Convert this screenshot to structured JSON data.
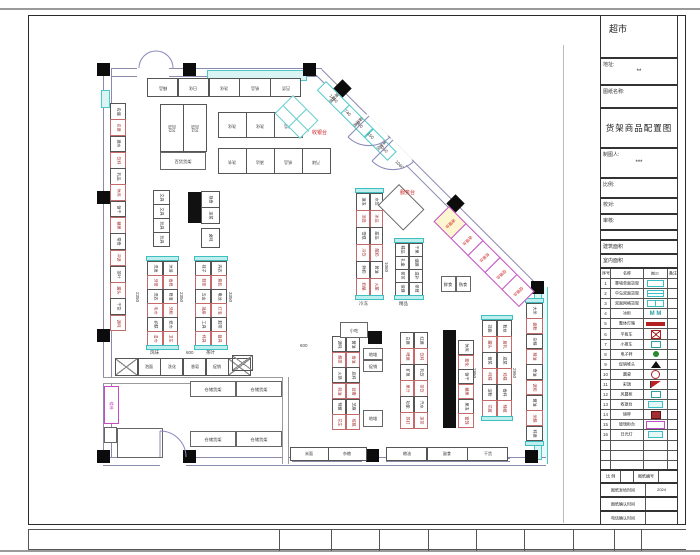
{
  "title_block": {
    "store_name": "超市",
    "address_label": "地址:",
    "address_value": "**",
    "drawing_name_label": "图纸名称:",
    "drawing_title": "货架商品配置图",
    "drafter_label": "制图人:",
    "drafter_value": "***",
    "scale_label": "比例:",
    "check_label": "校对:",
    "audit_label": "审核:",
    "building_area_label": "建筑面积",
    "indoor_area_label": "室内面积",
    "legend_header": [
      "序号",
      "名称",
      "图示",
      "备注"
    ],
    "legend_rows": [
      {
        "no": "1",
        "name": "靠墙单面货架",
        "sym": "cyanopen"
      },
      {
        "no": "2",
        "name": "中岛双面货架",
        "sym": "cyanrect"
      },
      {
        "no": "3",
        "name": "双面网格货架",
        "sym": "cyangrid"
      },
      {
        "no": "4",
        "name": "冰柜",
        "sym": "m",
        "symtext": "M M"
      },
      {
        "no": "5",
        "name": "整体灯箱",
        "sym": "redbar"
      },
      {
        "no": "6",
        "name": "平板车",
        "sym": "redx"
      },
      {
        "no": "7",
        "name": "小推车",
        "sym": "tealsm"
      },
      {
        "no": "8",
        "name": "电子秤",
        "sym": "green"
      },
      {
        "no": "9",
        "name": "促销堆头",
        "sym": "tri"
      },
      {
        "no": "10",
        "name": "圆桌",
        "sym": "circ"
      },
      {
        "no": "11",
        "name": "彩旗",
        "sym": "flag"
      },
      {
        "no": "12",
        "name": "风幕柜",
        "sym": "tealsm"
      },
      {
        "no": "13",
        "name": "收银台",
        "sym": "cyanbox"
      },
      {
        "no": "14",
        "name": "磅秤",
        "sym": "brown"
      },
      {
        "no": "15",
        "name": "玻璃柜台",
        "sym": "mag"
      },
      {
        "no": "16",
        "name": "日光灯",
        "sym": "cyanbox"
      },
      {
        "no": "",
        "name": "",
        "sym": "none"
      },
      {
        "no": "",
        "name": "",
        "sym": "none"
      },
      {
        "no": "",
        "name": "",
        "sym": "none"
      }
    ],
    "bottom_scale_label": "比 例",
    "bottom_no_label": "图纸编号",
    "issue_label": "图纸发给时间",
    "issue_value": "2024",
    "confirm_label": "图纸确认时间",
    "confirm_value": "",
    "phone_label": "电话确认时间",
    "phone_value": ""
  },
  "plan": {
    "walls": [
      {
        "x": 103,
        "y": 68,
        "w": 219,
        "h": 7,
        "t": "h"
      },
      {
        "x": 103,
        "y": 68,
        "w": 7,
        "h": 396,
        "t": "v"
      },
      {
        "x": 539,
        "y": 287,
        "w": 7,
        "h": 177,
        "t": "v",
        "cyan": true
      },
      {
        "x": 285,
        "y": 457,
        "w": 261,
        "h": 7,
        "t": "h"
      },
      {
        "x": 103,
        "y": 457,
        "w": 57,
        "h": 7,
        "t": "h"
      },
      {
        "x": 186,
        "y": 457,
        "w": 99,
        "h": 7,
        "t": "h"
      },
      {
        "x": 103,
        "y": 377,
        "w": 182,
        "h": 5,
        "t": "h",
        "thin": true
      },
      {
        "x": 282,
        "y": 377,
        "w": 5,
        "h": 87,
        "t": "v",
        "thin": true
      },
      {
        "x": 322,
        "y": 69,
        "w": 310,
        "h": 7,
        "t": "h",
        "rot": 45
      }
    ],
    "wall_gaps": [
      {
        "x": 137,
        "y": 66,
        "w": 32,
        "h": 11
      },
      {
        "x": 367,
        "y": 114,
        "w": 30,
        "h": 10,
        "rot": 45
      },
      {
        "x": 391,
        "y": 138,
        "w": 30,
        "h": 10,
        "rot": 45
      }
    ],
    "cyan_bands": [
      {
        "x": 207,
        "y": 70,
        "w": 98,
        "h": 9
      },
      {
        "x": 101,
        "y": 90,
        "w": 7,
        "h": 16
      },
      {
        "x": 534,
        "y": 292,
        "w": 6,
        "h": 166
      }
    ],
    "hatches": [
      {
        "x": 292,
        "y": 458,
        "w": 70,
        "h": 6
      },
      {
        "x": 386,
        "y": 458,
        "w": 124,
        "h": 6
      }
    ],
    "columns": [
      [
        97,
        63
      ],
      [
        183,
        63
      ],
      [
        303,
        63
      ],
      [
        97,
        191
      ],
      [
        97,
        329
      ],
      [
        97,
        450
      ],
      [
        183,
        450
      ],
      [
        366,
        449
      ],
      [
        525,
        450
      ],
      [
        531,
        281
      ],
      [
        336,
        82,
        45
      ],
      [
        449,
        197,
        45
      ]
    ],
    "black_bars": [
      [
        188,
        192,
        13,
        31
      ],
      [
        356,
        191,
        13,
        30
      ],
      [
        443,
        330,
        13,
        98
      ],
      [
        368,
        331,
        14,
        13
      ],
      [
        196,
        331,
        13,
        13
      ]
    ],
    "runs": [
      {
        "name": "left-wall-run",
        "x": 110,
        "y": 103,
        "w": 16,
        "h": 228,
        "dir": "v",
        "alt": true,
        "cells": [
          "名烟",
          "名酒",
          "酒水",
          "饮料",
          "乳品",
          "休闲",
          "饼干",
          "糖果",
          "零食",
          "冲调",
          "茶叶",
          "罐头",
          "干货",
          "调味"
        ]
      },
      {
        "name": "top-wall-run",
        "x": 147,
        "y": 78,
        "w": 154,
        "h": 19,
        "dir": "h",
        "rot180": true,
        "cells": [
          "精品",
          "日化",
          "洗化",
          "纸品",
          "百货"
        ]
      },
      {
        "name": "dept-block",
        "x": 160,
        "y": 104,
        "w": 46,
        "h": 48,
        "dir": "h",
        "rot180": true,
        "cells": [
          "915\n百货",
          "913\n百货"
        ]
      },
      {
        "name": "chem-run",
        "x": 218,
        "y": 112,
        "w": 84,
        "h": 26,
        "dir": "h",
        "rot180": true,
        "cells": [
          "洗化",
          "洗化",
          "纸品"
        ]
      },
      {
        "name": "clean-run",
        "x": 218,
        "y": 148,
        "w": 112,
        "h": 26,
        "dir": "h",
        "rot180": true,
        "cells": [
          "洗衣",
          "清洁",
          "纸品",
          "汽球"
        ]
      },
      {
        "name": "stationery-run",
        "x": 153,
        "y": 190,
        "w": 17,
        "h": 56,
        "dir": "v",
        "cells": [
          "文具",
          "文具",
          "玩具",
          "玩具"
        ]
      },
      {
        "name": "deli-run",
        "x": 201,
        "y": 191,
        "w": 19,
        "h": 32,
        "dir": "v",
        "cells": [
          "熟食",
          "凉菜"
        ]
      },
      {
        "name": "deli-run2",
        "x": 201,
        "y": 228,
        "w": 19,
        "h": 19,
        "dir": "v",
        "cells": [
          "卤味"
        ]
      },
      {
        "name": "gondola-1",
        "x": 147,
        "y": 256,
        "w": 31,
        "h": 94,
        "dir": "v",
        "cols": 2,
        "cap": true,
        "alt": true,
        "cells": [
          "洗发",
          "沐浴",
          "牙膏",
          "香皂",
          "洗衣",
          "皂液",
          "毛巾",
          "牙刷",
          "护肤",
          "纸巾",
          "湿巾",
          "卫生"
        ]
      },
      {
        "name": "gondola-2",
        "x": 195,
        "y": 256,
        "w": 32,
        "h": 94,
        "dir": "v",
        "cols": 2,
        "cap": true,
        "alt": true,
        "cells": [
          "袜子",
          "内衣",
          "鞋垫",
          "箱包",
          "五金",
          "电池",
          "插座",
          "灯泡",
          "工具",
          "胶带",
          "杯具",
          "餐具"
        ]
      },
      {
        "name": "frozen-run",
        "x": 356,
        "y": 188,
        "w": 27,
        "h": 112,
        "dir": "v",
        "cols": 2,
        "cap": true,
        "alt": true,
        "cells": [
          "速冻",
          "水饺",
          "汤圆",
          "冰品",
          "雪糕",
          "甜品",
          "冷饮",
          "酸奶",
          "鲜奶",
          "黄油",
          "奶酪",
          "火腿"
        ]
      },
      {
        "name": "boutique-run",
        "x": 395,
        "y": 238,
        "w": 28,
        "h": 62,
        "dir": "v",
        "cols": 2,
        "cap": true,
        "cells": [
          "精品",
          "干果",
          "礼盒",
          "烟酒",
          "茗茶",
          "滋补",
          "保健",
          "参茸"
        ]
      },
      {
        "name": "grocery-gondola",
        "x": 482,
        "y": 315,
        "w": 30,
        "h": 106,
        "dir": "v",
        "cols": 2,
        "cap": true,
        "alt": true,
        "cells": [
          "挂面",
          "粉丝",
          "罐头",
          "腐乳",
          "酱菜",
          "咸菜",
          "味精",
          "鸡精",
          "淀粉",
          "香料",
          "花椒",
          "辣椒"
        ]
      },
      {
        "name": "right-wall-run",
        "x": 526,
        "y": 298,
        "w": 17,
        "h": 148,
        "dir": "v",
        "cap": true,
        "alt": true,
        "cells": [
          "大米",
          "面粉",
          "杂粮",
          "粮油",
          "食油",
          "调和",
          "酱油",
          "米醋",
          "料酒"
        ]
      },
      {
        "name": "sauce-gondola",
        "x": 332,
        "y": 336,
        "w": 28,
        "h": 94,
        "dir": "v",
        "cols": 2,
        "alt": true,
        "cells": [
          "调味",
          "酱油",
          "醋类",
          "香油",
          "火锅",
          "底料",
          "蚝油",
          "豆瓣",
          "辣酱",
          "芝麻",
          "花生",
          "核桃"
        ]
      },
      {
        "name": "drinks-gondola",
        "x": 400,
        "y": 332,
        "w": 28,
        "h": 96,
        "dir": "v",
        "cols": 2,
        "alt": true,
        "cells": [
          "白酒",
          "红酒",
          "啤酒",
          "饮料",
          "矿泉",
          "乳饮",
          "果汁",
          "茶饮",
          "功能",
          "汽水",
          "苏打",
          "凉茶"
        ]
      },
      {
        "name": "snack-run",
        "x": 458,
        "y": 340,
        "w": 16,
        "h": 88,
        "dir": "v",
        "alt": true,
        "cells": [
          "休闲",
          "膨化",
          "饼干",
          "糖果",
          "果冻",
          "蜜饯"
        ]
      },
      {
        "name": "promo-run",
        "x": 115,
        "y": 358,
        "w": 136,
        "h": 18,
        "dir": "h",
        "cells": [
          "※",
          "泡面",
          "洗化",
          "香皂",
          "促销",
          "※"
        ]
      },
      {
        "name": "promo-end",
        "x": 232,
        "y": 355,
        "w": 20,
        "h": 16,
        "dir": "h",
        "cells": [
          "※"
        ]
      },
      {
        "name": "bottom-wall-run-1",
        "x": 290,
        "y": 447,
        "w": 76,
        "h": 14,
        "dir": "h",
        "cells": [
          "米面",
          "杂粮"
        ]
      },
      {
        "name": "bottom-wall-run-2",
        "x": 386,
        "y": 447,
        "w": 122,
        "h": 14,
        "dir": "h",
        "cells": [
          "粮油",
          "副食",
          "干货"
        ]
      },
      {
        "name": "checkout-run",
        "x": 449,
        "y": 206,
        "w": 120,
        "h": 22,
        "dir": "h",
        "rot": 45,
        "mag": true,
        "labelrot": 90,
        "firstyellow": true,
        "cells": [
          "收银台",
          "收银台",
          "包装台",
          "促销台",
          "促销台"
        ]
      },
      {
        "name": "locker-run",
        "x": 326,
        "y": 81,
        "w": 100,
        "h": 13,
        "dir": "h",
        "rot": 45,
        "cy": true,
        "labelrot": 90,
        "cells": [
          "寄存柜",
          "储物柜",
          "推车区"
        ]
      }
    ],
    "tables": [
      {
        "name": "dept-counter",
        "x": 160,
        "y": 152,
        "w": 46,
        "h": 18,
        "cells": [
          "百货货架"
        ]
      },
      {
        "name": "snack-stand",
        "x": 340,
        "y": 322,
        "w": 28,
        "h": 16,
        "cells": [
          "小吃"
        ]
      },
      {
        "name": "floor-stack-1",
        "x": 363,
        "y": 348,
        "w": 20,
        "h": 24,
        "rows": 2,
        "cells": [
          "地堆",
          "促销"
        ]
      },
      {
        "name": "floor-stack-2",
        "x": 363,
        "y": 410,
        "w": 20,
        "h": 17,
        "cells": [
          "地堆"
        ]
      },
      {
        "name": "fresh-counter",
        "x": 441,
        "y": 276,
        "w": 30,
        "h": 16,
        "cells": [
          "鲜食",
          "熟食"
        ]
      },
      {
        "name": "storage-rack-1",
        "x": 190,
        "y": 381,
        "w": 92,
        "h": 16,
        "cells": [
          "仓储货架",
          "仓储货架"
        ]
      },
      {
        "name": "storage-rack-2",
        "x": 190,
        "y": 431,
        "w": 92,
        "h": 16,
        "cells": [
          "仓储货架",
          "仓储货架"
        ]
      },
      {
        "name": "back-room",
        "x": 117,
        "y": 428,
        "w": 46,
        "h": 30,
        "cells": [
          ""
        ]
      },
      {
        "name": "small-room",
        "x": 104,
        "y": 427,
        "w": 13,
        "h": 16,
        "cells": [
          ""
        ]
      }
    ],
    "stair": {
      "x": 104,
      "y": 386,
      "w": 15,
      "h": 38,
      "label": "楼梯"
    },
    "service_desk": {
      "x": 399,
      "y": 184,
      "w": 36,
      "h": 30,
      "rot": 45
    },
    "tilted_grid": {
      "x": 293,
      "y": 95,
      "w": 36,
      "h": 26,
      "rot": 45
    },
    "red_labels": [
      {
        "t": "收银台",
        "x": 312,
        "y": 131,
        "r": 0
      },
      {
        "t": "服务台",
        "x": 400,
        "y": 191,
        "r": 0
      }
    ],
    "dims": [
      {
        "t": "1460",
        "x": 331,
        "y": 94,
        "r": 45
      },
      {
        "t": "740",
        "x": 346,
        "y": 109,
        "r": 45
      },
      {
        "t": "580",
        "x": 358,
        "y": 121,
        "r": 45
      },
      {
        "t": "150",
        "x": 369,
        "y": 132,
        "r": 45
      },
      {
        "t": "1060",
        "x": 381,
        "y": 144,
        "r": 45
      },
      {
        "t": "1060",
        "x": 397,
        "y": 160,
        "r": 45
      },
      {
        "t": "2350",
        "x": 139,
        "y": 292,
        "r": 90
      },
      {
        "t": "2350",
        "x": 183,
        "y": 292,
        "r": 90
      },
      {
        "t": "3350",
        "x": 232,
        "y": 292,
        "r": 90
      },
      {
        "t": "1060",
        "x": 388,
        "y": 262,
        "r": 90
      },
      {
        "t": "2950",
        "x": 476,
        "y": 368,
        "r": 90
      },
      {
        "t": "2950",
        "x": 516,
        "y": 368,
        "r": 90
      },
      {
        "t": "600",
        "x": 186,
        "y": 351,
        "r": 0
      },
      {
        "t": "600",
        "x": 300,
        "y": 344,
        "r": 0
      },
      {
        "t": "风味",
        "x": 150,
        "y": 351,
        "r": 0
      },
      {
        "t": "茶叶",
        "x": 206,
        "y": 351,
        "r": 0
      },
      {
        "t": "冷冻",
        "x": 359,
        "y": 302,
        "r": 0
      },
      {
        "t": "精品",
        "x": 399,
        "y": 302,
        "r": 0
      }
    ]
  }
}
